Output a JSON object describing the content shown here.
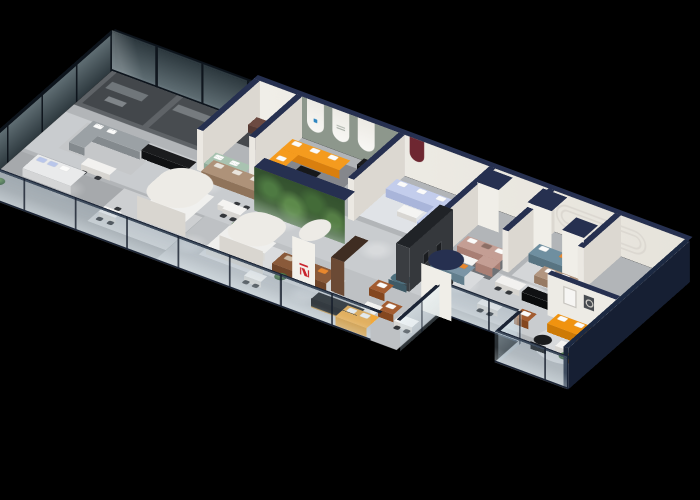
{
  "scene": {
    "description": "3D isometric cutaway render of a modern furniture showroom floor plan viewed from above on a black background",
    "background": "#000000",
    "palette": {
      "floor": "#b6b9bc",
      "walkway": "#d4d6d8",
      "wall": "#ebe8e2",
      "wall_cap": "#263050",
      "tinted_glass": "#3a474c",
      "railing_glass": "#bcd2de",
      "plant_green": "#3c5c38",
      "tv_wall": "#3a3d41",
      "sage_wall": "#8d978c",
      "maroon_niche": "#6e2731",
      "orange": "#f59b1e",
      "deep_orange": "#f0930f",
      "yellow": "#f2a93b",
      "periwinkle": "#c3cdec",
      "slate_blue": "#7b95a6",
      "teal": "#6f8fa0",
      "mauve": "#c49e94",
      "mint": "#a9c3b1",
      "tan": "#ae9279",
      "leather_brown": "#8a5a3a",
      "black_furniture": "#141517",
      "logo_red": "#c8232c",
      "logo_blue": "#2e86c1"
    },
    "zones": [
      {
        "id": "offices",
        "label": "Tinted glass private offices"
      },
      {
        "id": "entry",
        "label": "Entry niche with mint green sofa"
      },
      {
        "id": "arch-room",
        "label": "Arched display room with orange sectional"
      },
      {
        "id": "periwinkle-room",
        "label": "Periwinkle sectional showroom"
      },
      {
        "id": "central-lounge",
        "label": "Central lounge with media wall"
      },
      {
        "id": "office-nooks",
        "label": "Office nook displays"
      },
      {
        "id": "corner-suite",
        "label": "Corner suite with orange sectional"
      }
    ],
    "items": {
      "tinted_glass": "Tinted glass office wall",
      "arch_display": "Arched display wall",
      "orange_sectional": "Orange sectional sofa",
      "periwinkle_sectional": "Periwinkle sectional sofa",
      "plant_wall": "Glass plant wall",
      "tv_wall": "Charcoal media wall",
      "column": "Round column",
      "oval_column": "Oval column with red logo",
      "glass_railing": "Glass balustrade",
      "slate_sofa": "Slate blue sofa",
      "mauve_sectional": "Mauve sectional sofa",
      "yellow_loveseat": "Yellow loveseat",
      "mint_sofa": "Mint green sofa",
      "tan_sofa": "Tan three-seat sofa",
      "leather_sofa": "Brown leather sofa",
      "teal_sofa": "Teal sofa",
      "corner_sofa": "Orange corner sectional",
      "mirror_frame": "Mirror frame",
      "round_art": "Round art frame"
    }
  }
}
